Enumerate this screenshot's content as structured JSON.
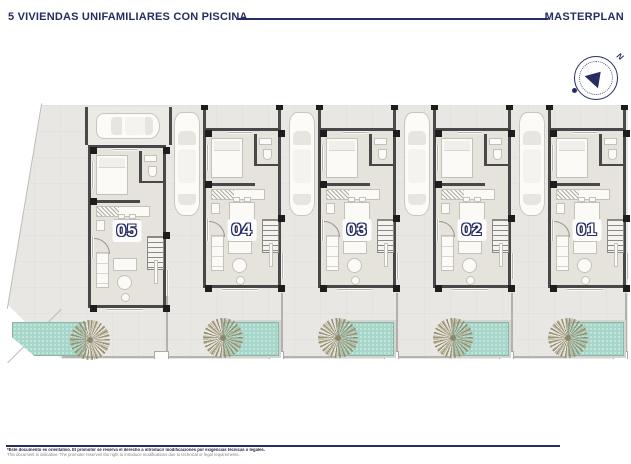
{
  "header": {
    "title": "5 VIVIENDAS UNIFAMILIARES CON PISCINA",
    "masterplan_label": "MASTERPLAN"
  },
  "compass": {
    "north_label": "N"
  },
  "houses": [
    {
      "label": "05"
    },
    {
      "label": "04"
    },
    {
      "label": "03"
    },
    {
      "label": "02"
    },
    {
      "label": "01"
    }
  ],
  "footer": {
    "disclaimer_es": "*Este documento es orientativo. El promotor se reserva el derecho a introducir modificaciones por exigencias técnicas o legales.",
    "disclaimer_en": "This document is indicative. The promoter reserves the right to introduce modifications due to technical or legal requirements."
  },
  "colors": {
    "accent_navy": "#272c62",
    "site_ground": "#e8e7e3",
    "wall_dark": "#484848",
    "pool_water": "#a5d6c9"
  }
}
